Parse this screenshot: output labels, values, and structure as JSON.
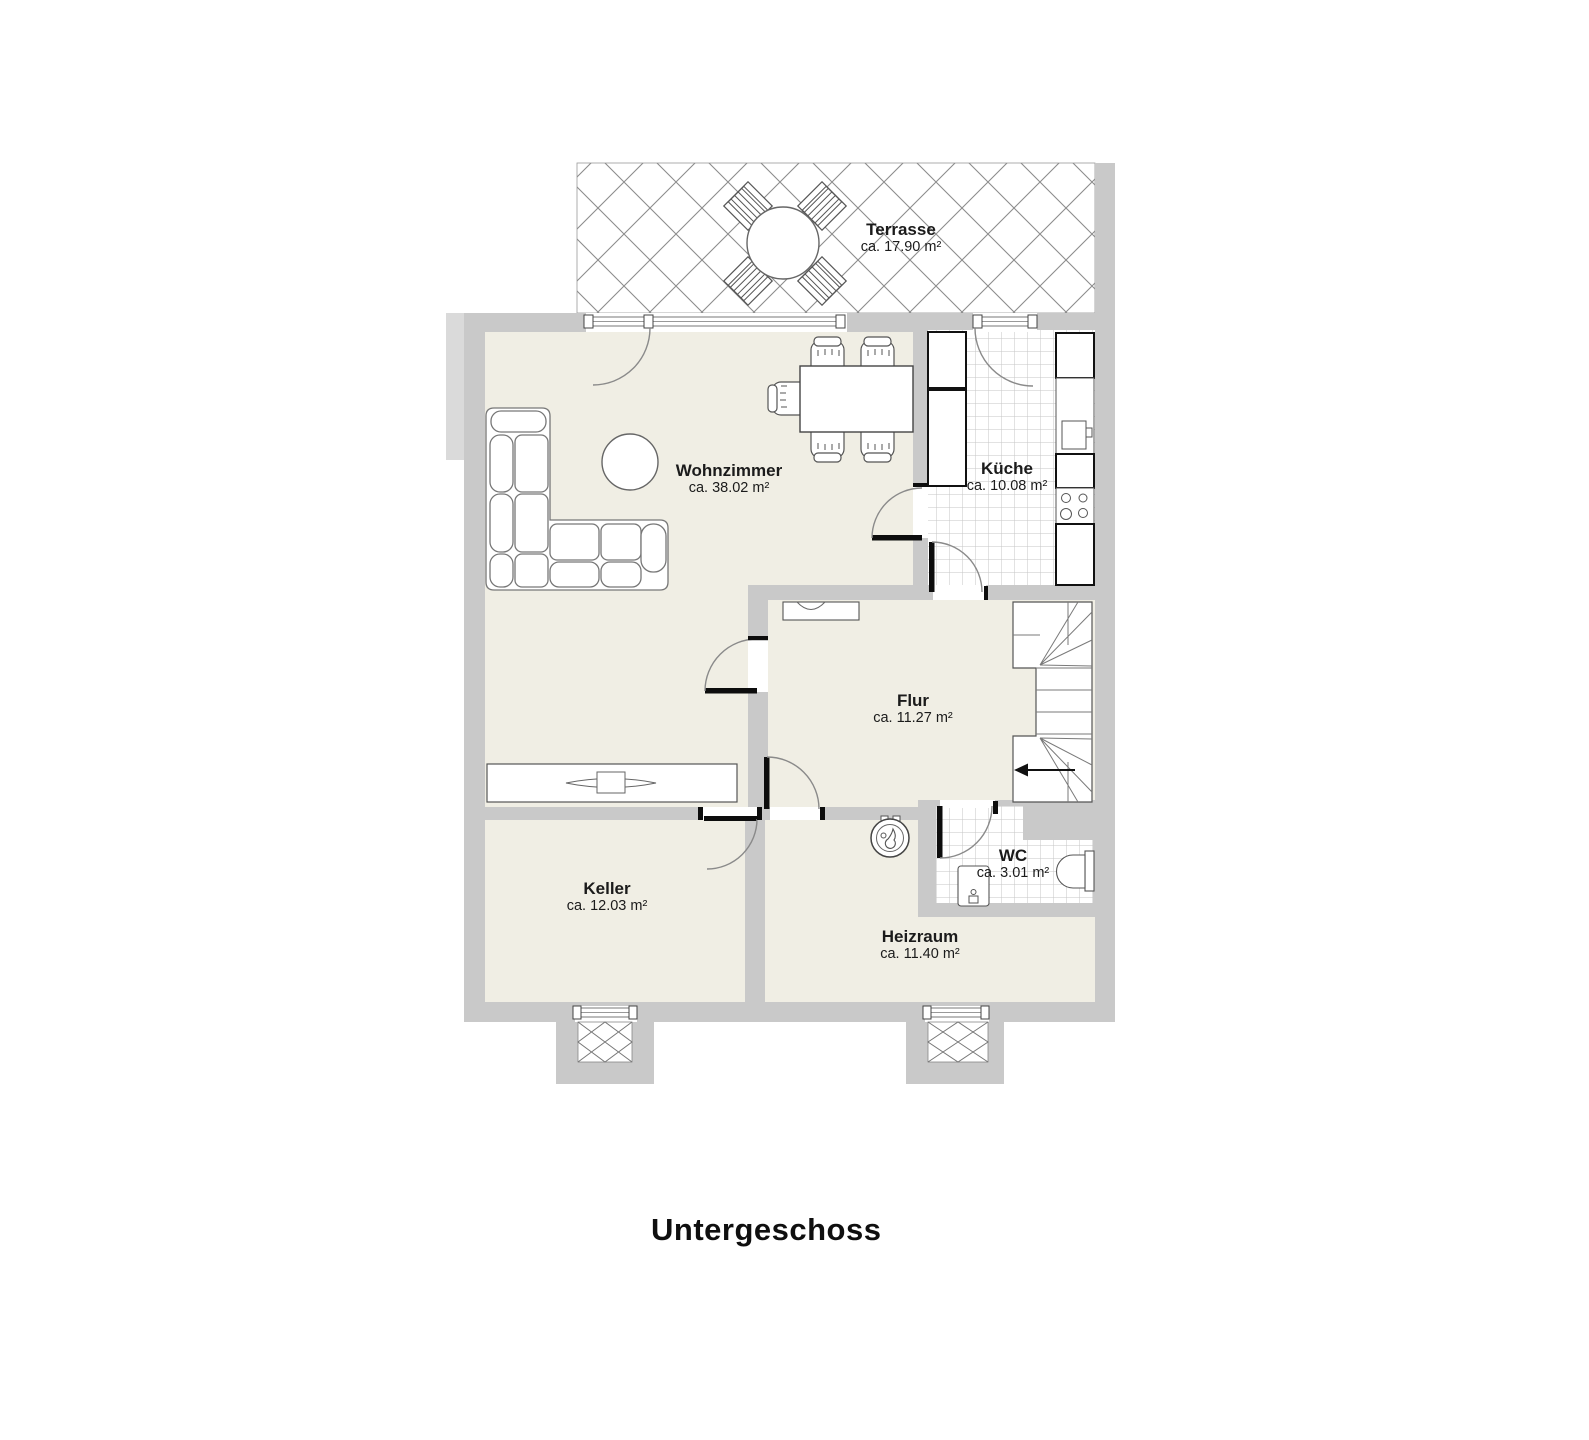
{
  "title": "Untergeschoss",
  "rooms": [
    {
      "name": "Terrasse",
      "area": "ca. 17.90 m²"
    },
    {
      "name": "Wohnzimmer",
      "area": "ca. 38.02 m²"
    },
    {
      "name": "Küche",
      "area": "ca. 10.08 m²"
    },
    {
      "name": "Flur",
      "area": "ca. 11.27 m²"
    },
    {
      "name": "Keller",
      "area": "ca. 12.03 m²"
    },
    {
      "name": "WC",
      "area": "ca. 3.01 m²"
    },
    {
      "name": "Heizraum",
      "area": "ca. 11.40 m²"
    }
  ],
  "colors": {
    "wall": "#c9c9c9",
    "floor": "#f0eee4",
    "tile_line": "#c6c6c6",
    "hatch_line": "#8c8c8c",
    "door_leaf": "#0d0d0d",
    "background": "#ffffff"
  }
}
